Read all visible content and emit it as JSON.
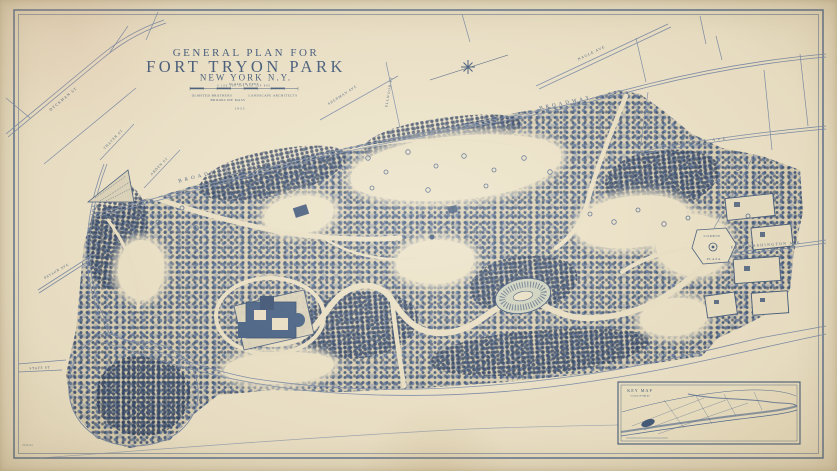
{
  "title_block": {
    "line1": "GENERAL PLAN FOR",
    "line2": "FORT TRYON PARK",
    "line3": "NEW YORK  N.Y.",
    "scale_label": "SCALE IN FEET",
    "scale_numbers": "0   100   200   300   400   500   600",
    "credit_left": "OLMSTED BROTHERS",
    "credit_right": "LANDSCAPE ARCHITECTS",
    "credit_city": "BROOKLINE MASS",
    "year": "1935"
  },
  "streets": {
    "broadway_west": "BROADWAY",
    "broadway_east": "BROADWAY",
    "dyckman": "DYCKMAN ST",
    "thayer": "THAYER ST",
    "arden": "ARDEN ST",
    "sherman": "SHERMAN AVE",
    "ellwood": "ELLWOOD ST",
    "nagle": "NAGLE AVE",
    "bennett": "BENNETT AVE",
    "fort_washington": "FORT WASHINGTON AVE",
    "riverside_west": "RIVERSIDE",
    "payson": "PAYSON AVE",
    "staff": "STAFF ST",
    "riverside_south": "RIVERSIDE",
    "drive_south": "DRIVE",
    "corbin_line1": "CORBIN",
    "corbin_line2": "PLAZA"
  },
  "key_map": {
    "title": "KEY MAP",
    "subtitle": "SCALE OF MILES"
  },
  "annotations": {
    "drawing_number": "2239-94"
  },
  "colors": {
    "ink": "#2e4a74",
    "ink_light": "#6f83a6",
    "paper": "#ece3cb",
    "paper_shade": "#d6cdb4"
  }
}
